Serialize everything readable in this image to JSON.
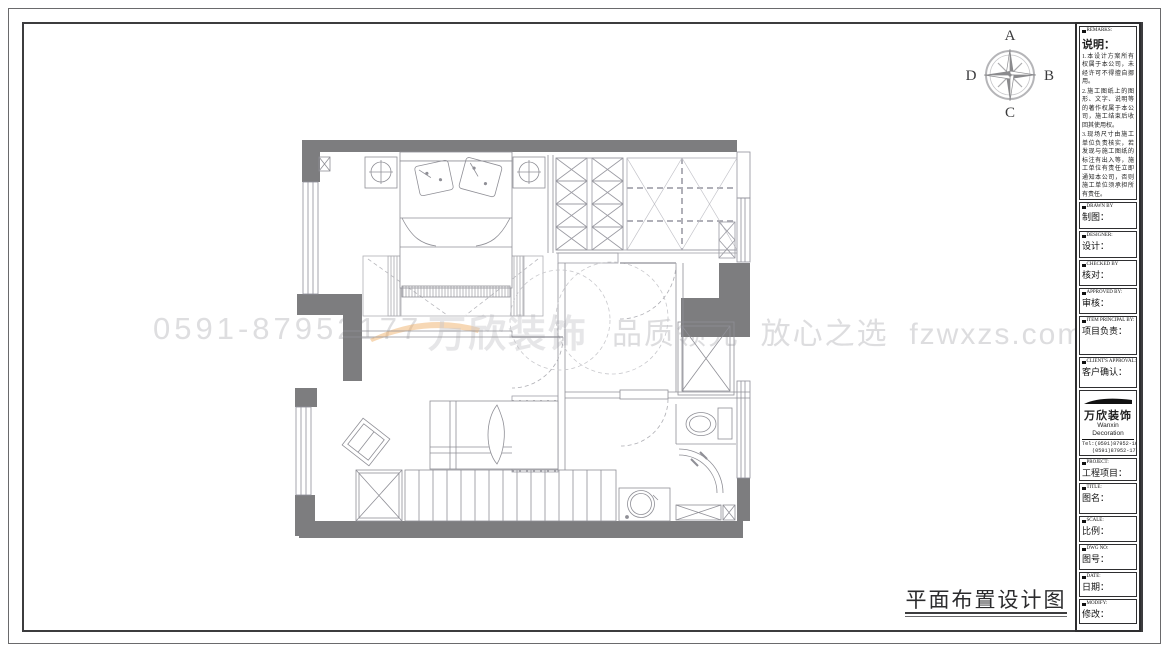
{
  "compass": {
    "north": "A",
    "east": "B",
    "south": "C",
    "west": "D"
  },
  "watermark": {
    "phone": "0591-87952177",
    "logo": "万欣装饰",
    "slogan": "品质领先  放心之选  fzwxzs.com"
  },
  "drawing": {
    "title": "平面布置设计图"
  },
  "title_block": {
    "remarks_header": "REMARKS:",
    "remarks_title": "说明：",
    "remarks_items": [
      "1.本设计方案所有权属于本公司，未经许可不得擅自挪用。",
      "2.施工图纸上的图形、文字、说明等的著作权属于本公司，施工结束后收回其使用权。",
      "3.现场尺寸由施工单位负责核实，若发现与施工图纸的标注有出入等，施工单位有责任立即通知本公司，否则施工单位须承担所有责任。",
      "4.本设计方案是依客户要求设计，经客户签字即视为同意认可，不得随意更改。"
    ],
    "fields": [
      {
        "en": "DRAWN BY",
        "cn": "制图："
      },
      {
        "en": "DESIGNER:",
        "cn": "设计："
      },
      {
        "en": "CHECKED BY",
        "cn": "核对："
      },
      {
        "en": "APPROVED BY:",
        "cn": "审核："
      },
      {
        "en": "ITEM PRINCIPAL BY:",
        "cn": "项目负责："
      },
      {
        "en": "CLIENT'S APPROVAL:",
        "cn": "客户确认："
      }
    ],
    "company": {
      "logo_cn": "万欣装饰",
      "logo_en": "Wanxin Decoration",
      "tel1": "Tel:(0591)87952-166",
      "tel2": "(0591)87952-177",
      "fax": "Fax:(0591)87952-199",
      "web": "Web:WWW.fzwxzs.com"
    },
    "fields2": [
      {
        "en": "PROJECT:",
        "cn": "工程项目："
      },
      {
        "en": "TITLE:",
        "cn": "图名："
      },
      {
        "en": "SCALE:",
        "cn": "比例："
      },
      {
        "en": "DWG NO:",
        "cn": "图号："
      },
      {
        "en": "DATE:",
        "cn": "日期："
      },
      {
        "en": "MODIFY:",
        "cn": "修改："
      }
    ]
  }
}
